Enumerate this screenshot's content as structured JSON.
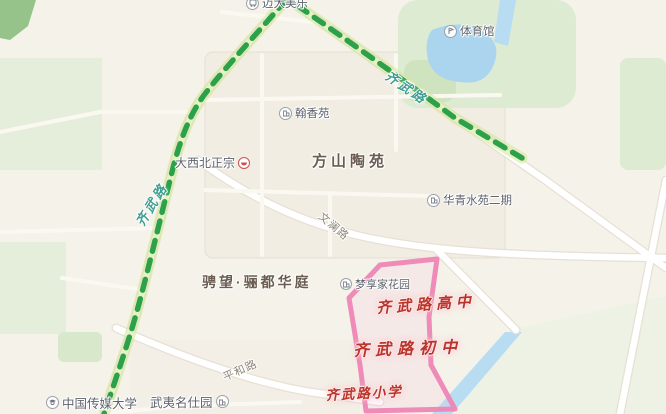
{
  "labels": {
    "bus_stop": "迈大美乐",
    "gym": "体育馆",
    "hanxiang": "翰香苑",
    "fangshan": "方山陶苑",
    "noodle1": "大西北正宗",
    "noodle2": "牛肉拉面",
    "huaqing": "华青水苑二期",
    "wenlan_road": "文澜路",
    "chengwang": "骋望·骊都华庭",
    "mengxiangjia": "梦享家花园",
    "kindergarten1": "蒙特梭",
    "kindergarten2": "利幼儿园",
    "school_high": "齐武路高中",
    "school_middle": "齐武路初中",
    "school_primary": "齐武路小学",
    "pinghe_road": "平和路",
    "cuc": "中国传媒大学",
    "wuyi": "武夷名仕园",
    "route_label_left": "齐武路",
    "route_label_right": "齐武路"
  },
  "colors": {
    "route_green": "#2ca04b",
    "boundary_pink": "#ee86b6",
    "school_red": "#b8352a",
    "water_blue": "#abd4ef",
    "park_green": "#dcebd2",
    "land": "#f5f2ea"
  }
}
